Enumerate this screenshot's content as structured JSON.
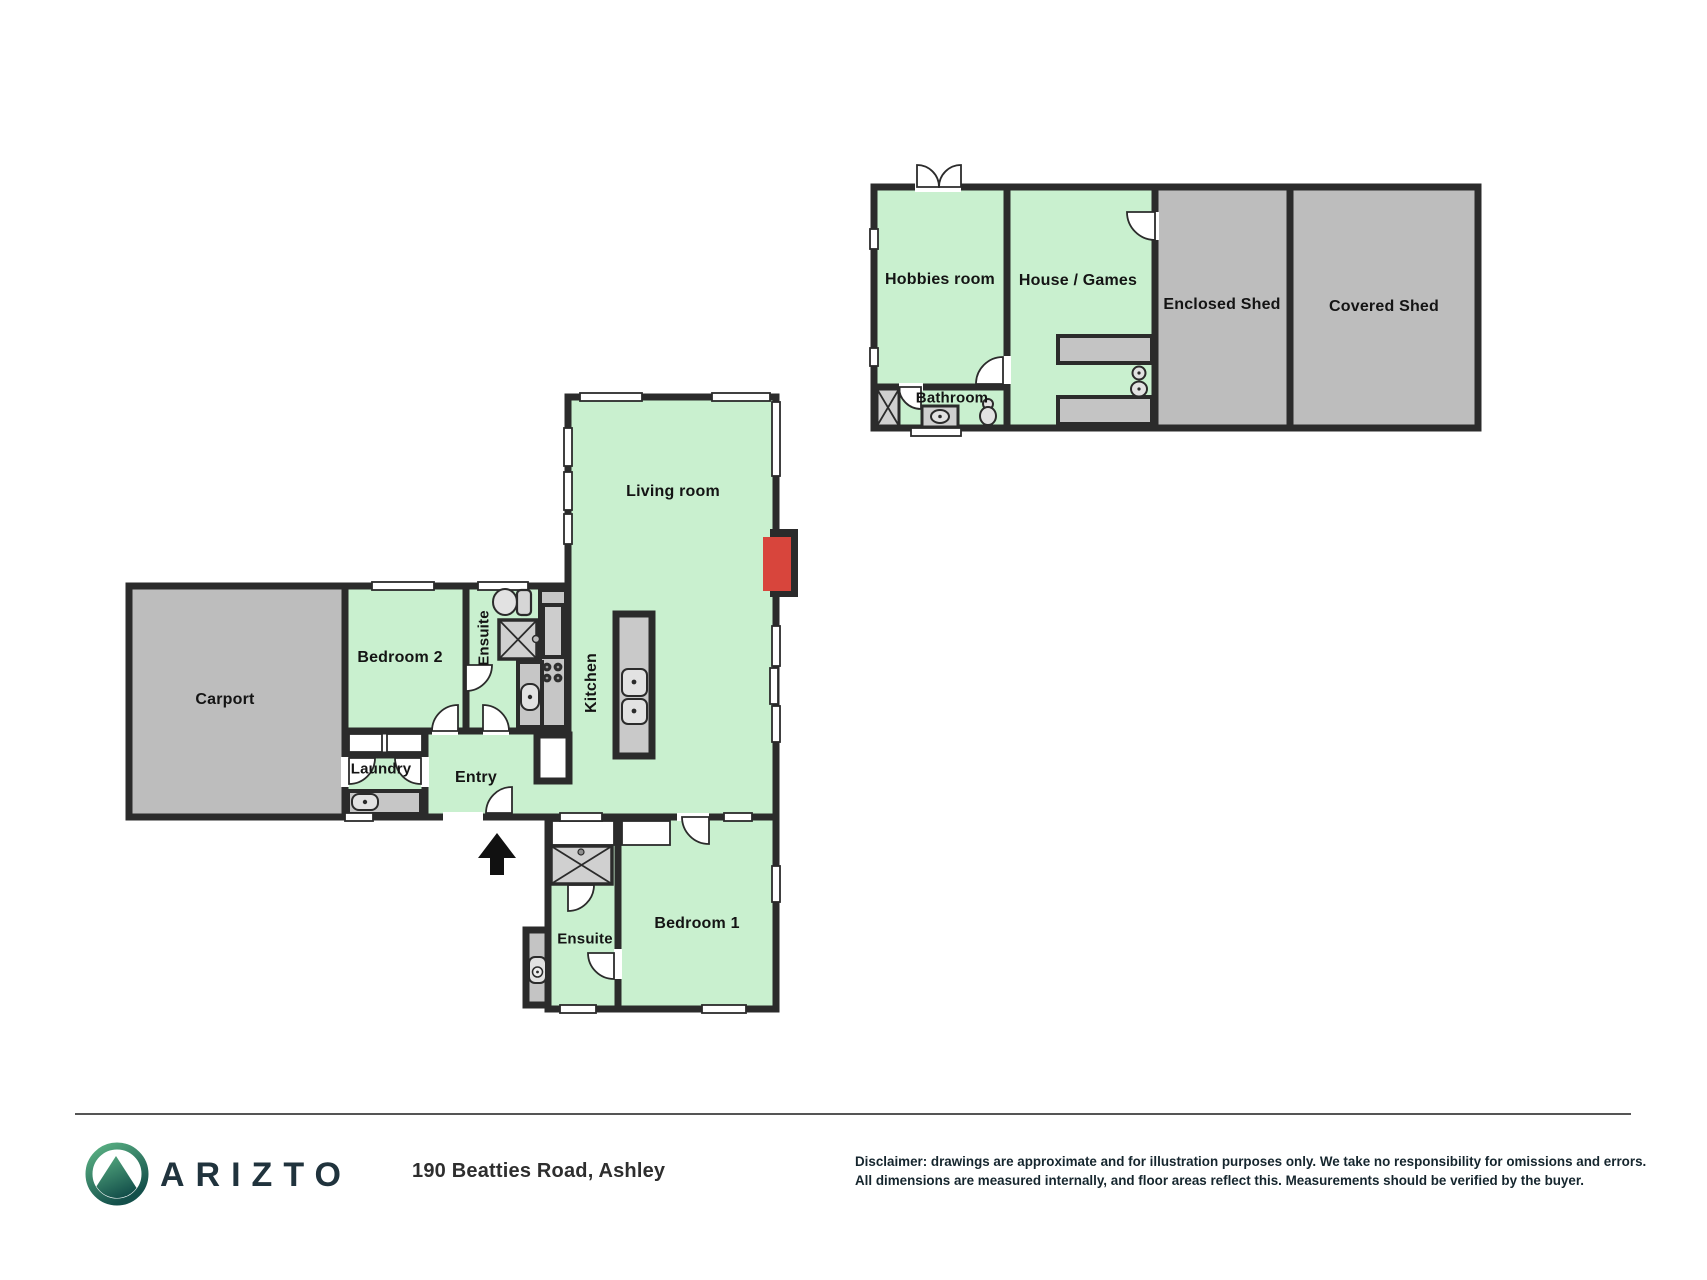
{
  "floorplan": {
    "rooms": {
      "living_room": "Living room",
      "kitchen": "Kitchen",
      "bedroom_2": "Bedroom 2",
      "ensuite_top": "Ensuite",
      "carport": "Carport",
      "laundry": "Laundry",
      "entry": "Entry",
      "bedroom_1": "Bedroom 1",
      "ensuite_bottom": "Ensuite",
      "hobbies_room": "Hobbies room",
      "house_games": "House / Games",
      "enclosed_shed": "Enclosed Shed",
      "covered_shed": "Covered Shed",
      "bathroom": "Bathroom"
    }
  },
  "footer": {
    "brand": "ARIZTO",
    "address": "190 Beatties Road, Ashley",
    "disclaimer_line1": "Disclaimer: drawings are approximate and for illustration purposes only. We take no responsibility for omissions and errors.",
    "disclaimer_line2": "All dimensions are measured internally, and floor areas reflect this. Measurements should be verified by the buyer."
  },
  "colors": {
    "room_green": "#c9f0cf",
    "room_gray": "#bdbdbd",
    "wall_dark": "#2b2b2b",
    "fireplace_red": "#d8453c",
    "brand_green": "#5cb485",
    "brand_teal_dark": "#14504b",
    "brand_text": "#20333d"
  }
}
